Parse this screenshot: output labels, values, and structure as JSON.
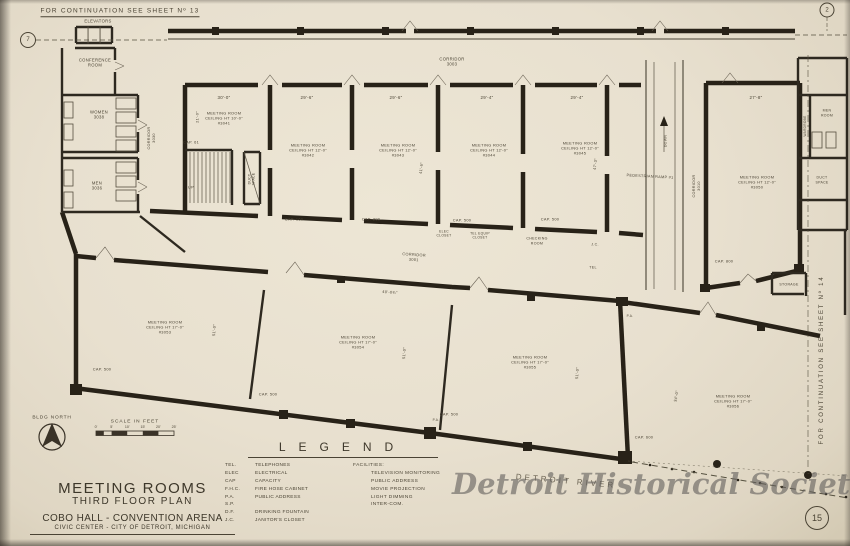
{
  "sheet": {
    "number": "15",
    "continuation_top": "FOR CONTINUATION SEE SHEET Nº 13",
    "continuation_right": "FOR CONTINUATION SEE SHEET Nº 14",
    "grid_marker_left": "7",
    "grid_marker_right": "2",
    "watermark": "Detroit Historical Society",
    "river_label": "DETROIT RIVER"
  },
  "title_block": {
    "title": "MEETING ROOMS",
    "subtitle": "THIRD FLOOR PLAN",
    "building": "COBO HALL - CONVENTION ARENA",
    "location": "CIVIC CENTER - CITY OF DETROIT, MICHIGAN"
  },
  "north_arrow": {
    "label": "BLDG NORTH"
  },
  "scale_bar": {
    "label": "SCALE IN FEET",
    "ticks": [
      "0'",
      "5'",
      "10'",
      "15'",
      "20'",
      "25'"
    ]
  },
  "legend": {
    "title": "LEGEND",
    "abbreviations": [
      {
        "abbr": "TEL.",
        "def": "TELEPHONES"
      },
      {
        "abbr": "ELEC",
        "def": "ELECTRICAL"
      },
      {
        "abbr": "CAP",
        "def": "CAPACITY"
      },
      {
        "abbr": "F.H.C.",
        "def": "FIRE HOSE CABINET"
      },
      {
        "abbr": "P.A.",
        "def": "PUBLIC ADDRESS"
      },
      {
        "abbr": "S.P.",
        "def": ""
      },
      {
        "abbr": "D.F.",
        "def": "DRINKING FOUNTAIN"
      },
      {
        "abbr": "J.C.",
        "def": "JANITOR'S CLOSET"
      }
    ],
    "facilities_title": "FACILITIES:",
    "facilities": [
      "TELEVISION MONITORING",
      "PUBLIC ADDRESS",
      "MOVIE PROJECTION",
      "LIGHT DIMMING",
      "INTER-COM."
    ]
  },
  "plan_labels": [
    {
      "name": "label-elevators",
      "text": "ELEVATORS",
      "x": 98,
      "y": 21,
      "size": 4.2
    },
    {
      "name": "label-conference-room",
      "text": "CONFERENCE\nROOM",
      "x": 95,
      "y": 63,
      "size": 4.2
    },
    {
      "name": "label-women-room",
      "text": "WOMEN\n3038",
      "x": 99,
      "y": 115,
      "size": 4.2
    },
    {
      "name": "label-men-room-left",
      "text": "MEN\n3036",
      "x": 97,
      "y": 186,
      "size": 4.2
    },
    {
      "name": "label-corridor-3030",
      "text": "CORRIDOR\n3030",
      "x": 152,
      "y": 138,
      "size": 3.8,
      "rot": -90
    },
    {
      "name": "label-corridor-3003",
      "text": "CORRIDOR\n3003",
      "x": 452,
      "y": 62,
      "size": 4.2
    },
    {
      "name": "room-3041",
      "text": "MEETING ROOM\nCEILING HT 10'-0\"\n#3041",
      "x": 224,
      "y": 118,
      "size": 3.9
    },
    {
      "name": "dim-3041-width",
      "text": "30'-0\"",
      "x": 224,
      "y": 98,
      "size": 4.4
    },
    {
      "name": "dim-3041-depth",
      "text": "21'-0\"",
      "x": 197,
      "y": 117,
      "size": 3.9,
      "rot": -90
    },
    {
      "name": "cap-3041",
      "text": "CAP. 61",
      "x": 191,
      "y": 142,
      "size": 3.9
    },
    {
      "name": "label-up",
      "text": "UP",
      "x": 191,
      "y": 187,
      "size": 3.9
    },
    {
      "name": "label-duct-space-stairs",
      "text": "DUCT\nSPACE",
      "x": 252,
      "y": 179,
      "size": 3.4,
      "rot": -90
    },
    {
      "name": "room-3042",
      "text": "MEETING ROOM\nCEILING HT 12'-0\"\n#3042",
      "x": 308,
      "y": 150,
      "size": 3.9
    },
    {
      "name": "dim-3042-width",
      "text": "29'-6\"",
      "x": 307,
      "y": 98,
      "size": 4.4
    },
    {
      "name": "cap-3042",
      "text": "CAP. 160",
      "x": 294,
      "y": 219,
      "size": 3.9
    },
    {
      "name": "room-3043",
      "text": "MEETING ROOM\nCEILING HT 12'-0\"\n#3043",
      "x": 398,
      "y": 150,
      "size": 3.9
    },
    {
      "name": "dim-3043-width",
      "text": "29'-6\"",
      "x": 396,
      "y": 98,
      "size": 4.4
    },
    {
      "name": "dim-3043-depth",
      "text": "41'-6\"",
      "x": 421,
      "y": 168,
      "size": 3.9,
      "rot": -83
    },
    {
      "name": "cap-3043",
      "text": "CAP. 200",
      "x": 371,
      "y": 219,
      "size": 3.9
    },
    {
      "name": "room-3044",
      "text": "MEETING ROOM\nCEILING HT 12'-0\"\n#3044",
      "x": 489,
      "y": 150,
      "size": 3.9
    },
    {
      "name": "dim-3044-width",
      "text": "29'-4\"",
      "x": 487,
      "y": 98,
      "size": 4.4
    },
    {
      "name": "cap-3044",
      "text": "CAP. 500",
      "x": 462,
      "y": 220,
      "size": 3.9
    },
    {
      "name": "room-3045",
      "text": "MEETING ROOM\nCEILING HT 12'-0\"\n#3045",
      "x": 580,
      "y": 148,
      "size": 3.9
    },
    {
      "name": "dim-3045-width",
      "text": "29'-4\"",
      "x": 577,
      "y": 98,
      "size": 4.4
    },
    {
      "name": "dim-3045-depth",
      "text": "47'-3\"",
      "x": 595,
      "y": 164,
      "size": 3.9,
      "rot": -83
    },
    {
      "name": "cap-3045",
      "text": "CAP. 500",
      "x": 550,
      "y": 219,
      "size": 3.9
    },
    {
      "name": "label-pedestrian-ramp",
      "text": "PEDESTRIAN RAMP #1",
      "x": 650,
      "y": 177,
      "size": 3.8,
      "rot": 3
    },
    {
      "name": "label-down",
      "text": "DOWN",
      "x": 666,
      "y": 141,
      "size": 3.5,
      "rot": -90
    },
    {
      "name": "label-corridor-3010",
      "text": "CORRIDOR\n3010",
      "x": 697,
      "y": 186,
      "size": 3.8,
      "rot": -90
    },
    {
      "name": "room-3050",
      "text": "MEETING ROOM\nCEILING HT 12'-0\"\n#3050",
      "x": 757,
      "y": 182,
      "size": 3.9
    },
    {
      "name": "dim-3050-width",
      "text": "27'-8\"",
      "x": 756,
      "y": 98,
      "size": 4.4
    },
    {
      "name": "cap-3050",
      "text": "CAP. 800",
      "x": 724,
      "y": 261,
      "size": 3.9
    },
    {
      "name": "label-wardrobe",
      "text": "WARDROBE",
      "x": 805,
      "y": 126,
      "size": 3.2,
      "rot": -90
    },
    {
      "name": "label-men-room-right",
      "text": "MEN\nROOM",
      "x": 827,
      "y": 113,
      "size": 3.5
    },
    {
      "name": "label-duct-space-right",
      "text": "DUCT\nSPACE",
      "x": 822,
      "y": 180,
      "size": 3.5
    },
    {
      "name": "label-storage",
      "text": "STORAGE",
      "x": 789,
      "y": 285,
      "size": 3.5
    },
    {
      "name": "label-elec-closet",
      "text": "ELEC\nCLOSET",
      "x": 444,
      "y": 234,
      "size": 3.3
    },
    {
      "name": "label-tel-equip-closet",
      "text": "TEL EQUIP\nCLOSET",
      "x": 480,
      "y": 236,
      "size": 3.3
    },
    {
      "name": "label-checking-room",
      "text": "CHECKING\nROOM",
      "x": 537,
      "y": 241,
      "size": 3.6
    },
    {
      "name": "label-jc",
      "text": "J.C.",
      "x": 595,
      "y": 245,
      "size": 3.6
    },
    {
      "name": "label-tel",
      "text": "TEL",
      "x": 593,
      "y": 268,
      "size": 3.6
    },
    {
      "name": "label-corridor-3001",
      "text": "CORRIDOR\n3001",
      "x": 414,
      "y": 257,
      "size": 3.9,
      "rot": 4
    },
    {
      "name": "room-3053",
      "text": "MEETING ROOM\nCEILING HT 17'-0\"\n#3053",
      "x": 165,
      "y": 327,
      "size": 3.9
    },
    {
      "name": "dim-3053-depth",
      "text": "51'-0\"",
      "x": 214,
      "y": 330,
      "size": 3.9,
      "rot": -85
    },
    {
      "name": "cap-3053",
      "text": "CAP. 500",
      "x": 102,
      "y": 369,
      "size": 3.9
    },
    {
      "name": "room-3054",
      "text": "MEETING ROOM\nCEILING HT 17'-0\"\n#3054",
      "x": 358,
      "y": 342,
      "size": 3.9
    },
    {
      "name": "dim-3054-top",
      "text": "40'-0¾\"",
      "x": 390,
      "y": 292,
      "size": 3.9,
      "rot": 4
    },
    {
      "name": "dim-3054-depth",
      "text": "51'-0\"",
      "x": 404,
      "y": 353,
      "size": 3.9,
      "rot": -85
    },
    {
      "name": "cap-3054",
      "text": "CAP. 500",
      "x": 268,
      "y": 394,
      "size": 3.9
    },
    {
      "name": "room-3055",
      "text": "MEETING ROOM\nCEILING HT 17'-0\"\n#3055",
      "x": 530,
      "y": 362,
      "size": 3.9
    },
    {
      "name": "dim-3055-depth",
      "text": "51'-0\"",
      "x": 577,
      "y": 373,
      "size": 3.9,
      "rot": -85
    },
    {
      "name": "cap-3055",
      "text": "CAP. 500",
      "x": 449,
      "y": 414,
      "size": 3.9
    },
    {
      "name": "label-pa-1",
      "text": "P.A.",
      "x": 436,
      "y": 420,
      "size": 3.2
    },
    {
      "name": "label-pa-2",
      "text": "P.A.",
      "x": 630,
      "y": 316,
      "size": 3.2
    },
    {
      "name": "room-3056",
      "text": "MEETING ROOM\nCEILING HT 17'-0\"\n#3056",
      "x": 733,
      "y": 401,
      "size": 3.9
    },
    {
      "name": "dim-3056-depth",
      "text": "34'-0\"",
      "x": 676,
      "y": 396,
      "size": 3.9,
      "rot": -80
    },
    {
      "name": "cap-3056",
      "text": "CAP. 600",
      "x": 644,
      "y": 437,
      "size": 3.9
    }
  ]
}
